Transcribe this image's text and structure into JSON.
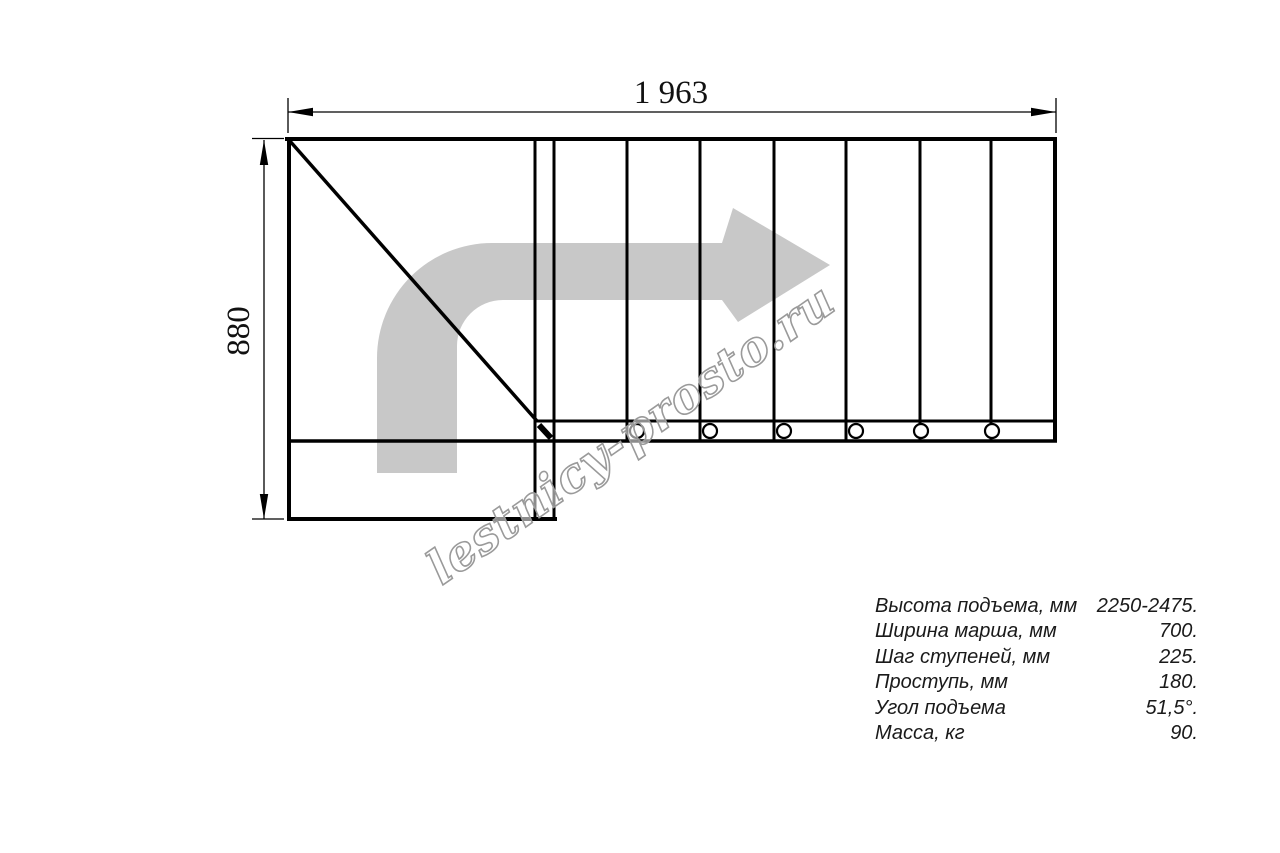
{
  "drawing": {
    "dimension_width": "1 963",
    "dimension_height": "880",
    "watermark": "lestnicy-prosto.ru",
    "plan": {
      "straight_flight_steps": 7,
      "screw_holes": 6,
      "turn_direction": "right"
    },
    "colors": {
      "line": "#000000",
      "arrow": "#c8c8c8",
      "watermark_outline": "#9a9a9a",
      "text": "#1a1a1a"
    }
  },
  "specs": {
    "rows": [
      {
        "label": "Высота подъема, мм",
        "value": "2250-2475."
      },
      {
        "label": "Ширина марша, мм",
        "value": "700."
      },
      {
        "label": "Шаг ступеней, мм",
        "value": "225."
      },
      {
        "label": "Проступь, мм",
        "value": "180."
      },
      {
        "label": "Угол подъема",
        "value": "51,5°."
      },
      {
        "label": "Масса, кг",
        "value": "90."
      }
    ]
  }
}
